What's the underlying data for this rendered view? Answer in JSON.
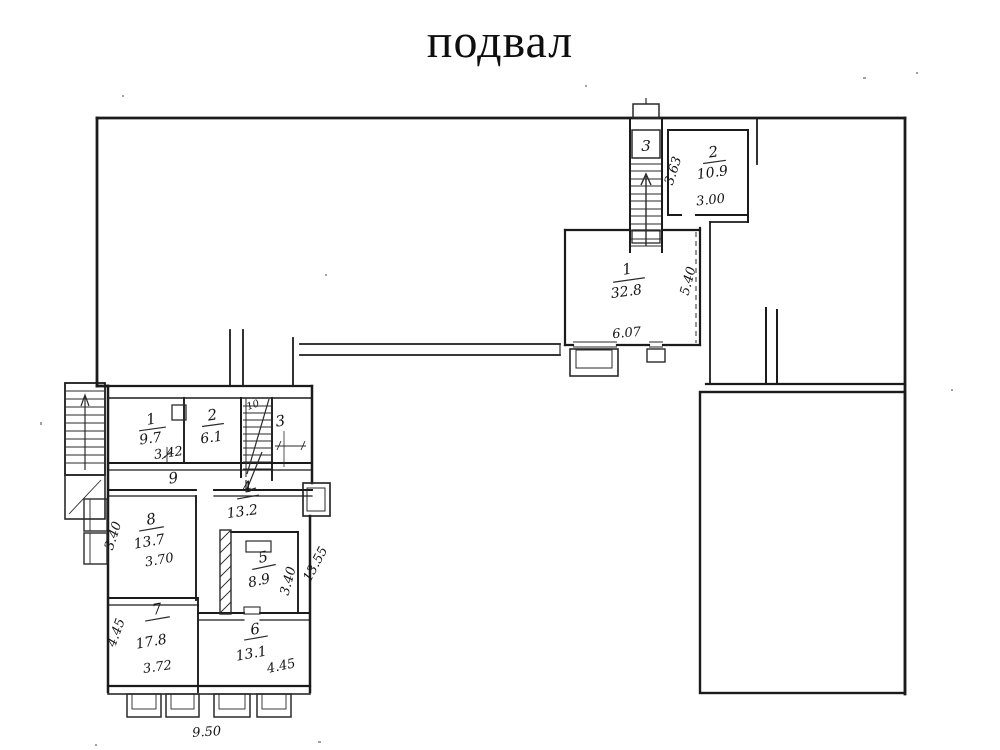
{
  "title": "подвал",
  "colors": {
    "ink": "#1b1b1b",
    "paper": "#ffffff"
  },
  "upper_section": {
    "stairwell": {
      "number": "3"
    },
    "room_1": {
      "number": "1",
      "area": "32.8",
      "width_dim": "6.07",
      "height_dim": "5.40"
    },
    "room_2": {
      "number": "2",
      "area": "10.9",
      "width_dim": "3.00",
      "height_dim": "3.63"
    }
  },
  "lower_section": {
    "room_1": {
      "number": "1",
      "area": "9.7",
      "width_dim": "3.42"
    },
    "room_2": {
      "number": "2",
      "area": "6.1"
    },
    "room_3": {
      "number": "3"
    },
    "room_4": {
      "number": "4",
      "area": "13.2"
    },
    "room_5": {
      "number": "5",
      "area": "8.9",
      "height_dim": "3.40"
    },
    "room_6": {
      "number": "6",
      "area": "13.1",
      "width_dim": "4.45"
    },
    "room_7": {
      "number": "7",
      "area": "17.8",
      "width_dim": "3.72",
      "height_dim": "4.45"
    },
    "room_8": {
      "number": "8",
      "area": "13.7",
      "width_dim": "3.70",
      "height_dim": "3.40"
    },
    "corridor": {
      "number": "9"
    },
    "stairwell": {
      "number": "10"
    },
    "overall_width_dim": "9.50",
    "overall_height_dim": "13.55"
  }
}
